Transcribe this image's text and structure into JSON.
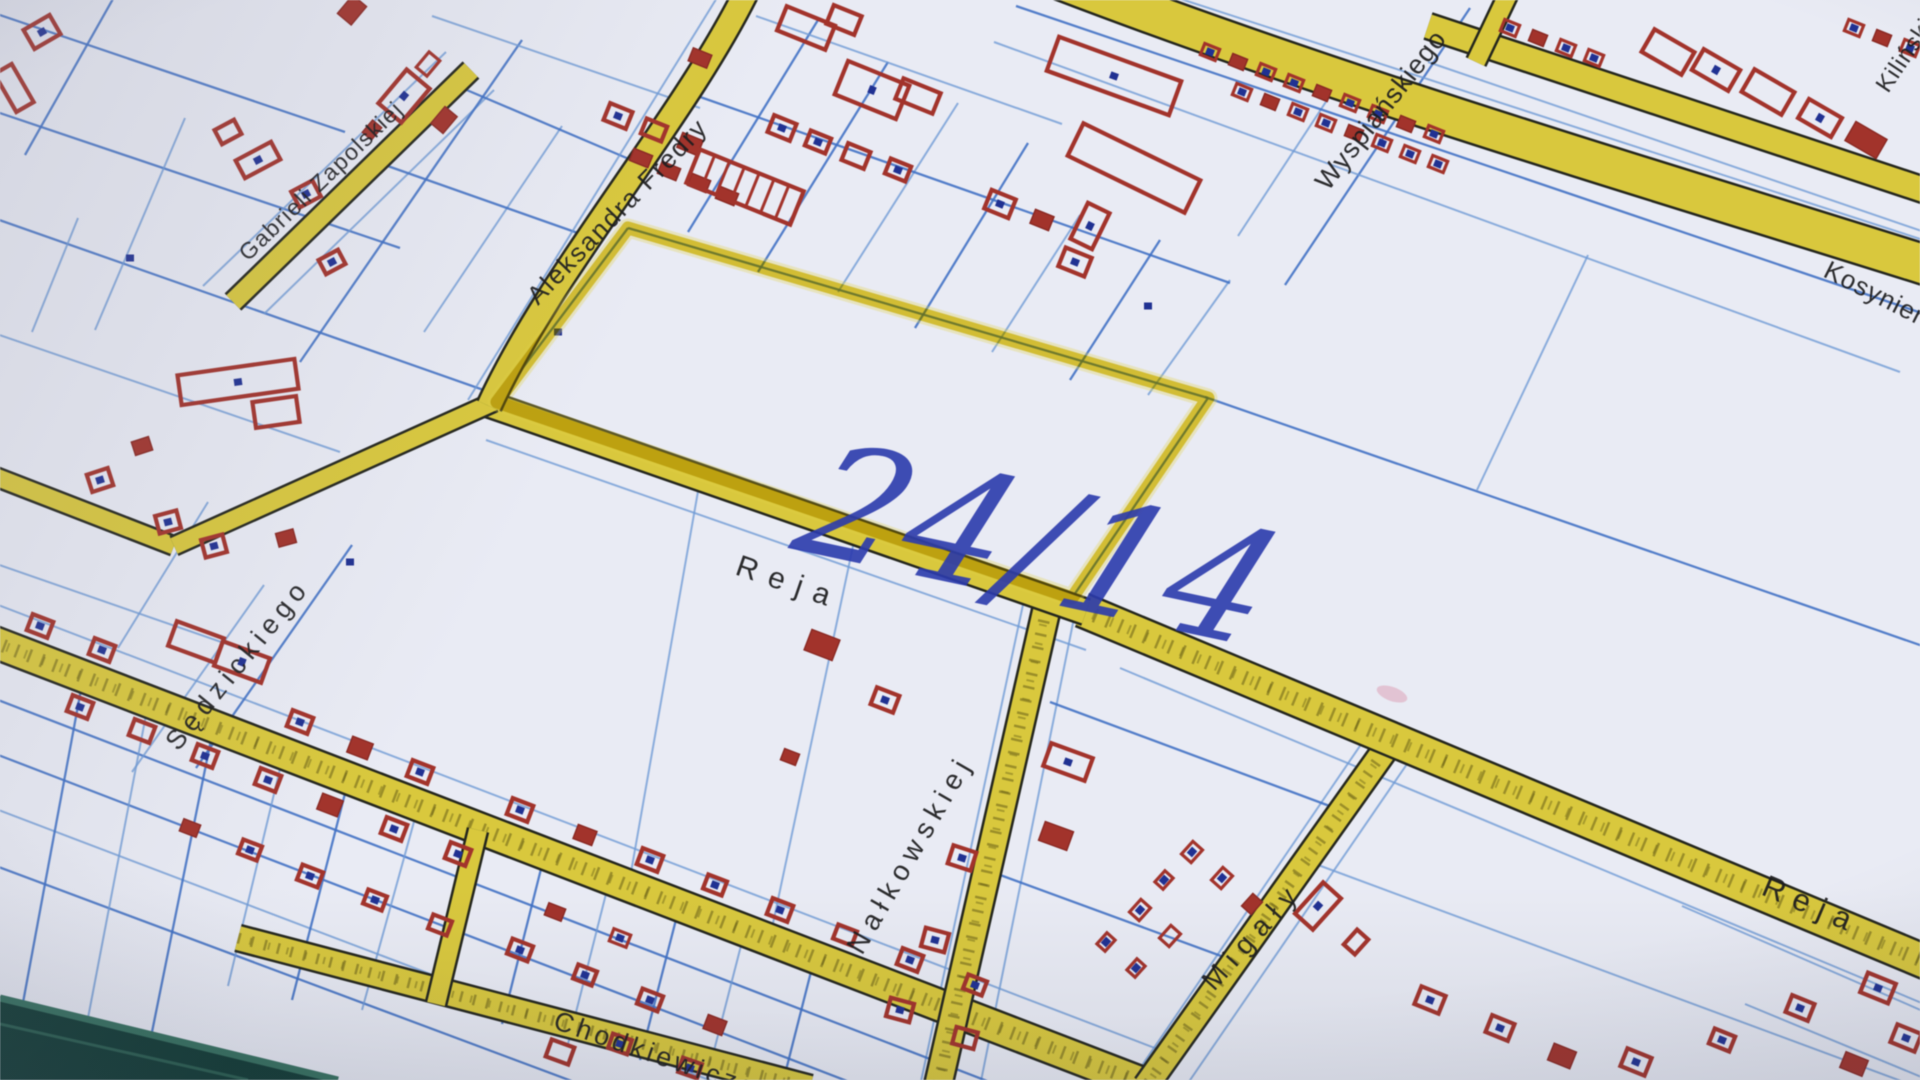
{
  "streets": {
    "gabrieli_zapolskiej": "Gabrieli Zapolskiej",
    "aleksandra_fredry": "Aleksandra Fredry",
    "wyspianskiego": "Wyspiańskiego",
    "kosynierow": "Kosynierów",
    "kilinskiego": "Kilińskiego",
    "reja": "Reja",
    "sedzickiego": "Sędzickiego",
    "nalkowskiej": "Nałkowskiej",
    "migaly": "Migały",
    "chodkiewicza": "Chodkiewicza"
  },
  "annotation": {
    "parcel_number": "24/14"
  },
  "colors": {
    "road_yellow": "#d9c940",
    "parcel_line_blue": "#4070c2",
    "building_red": "#a0332b",
    "address_dot_navy": "#20308f",
    "highlight_yellow": "#d4be1e",
    "ink_blue": "#2b3aaa",
    "paper": "#e9ebf4"
  }
}
